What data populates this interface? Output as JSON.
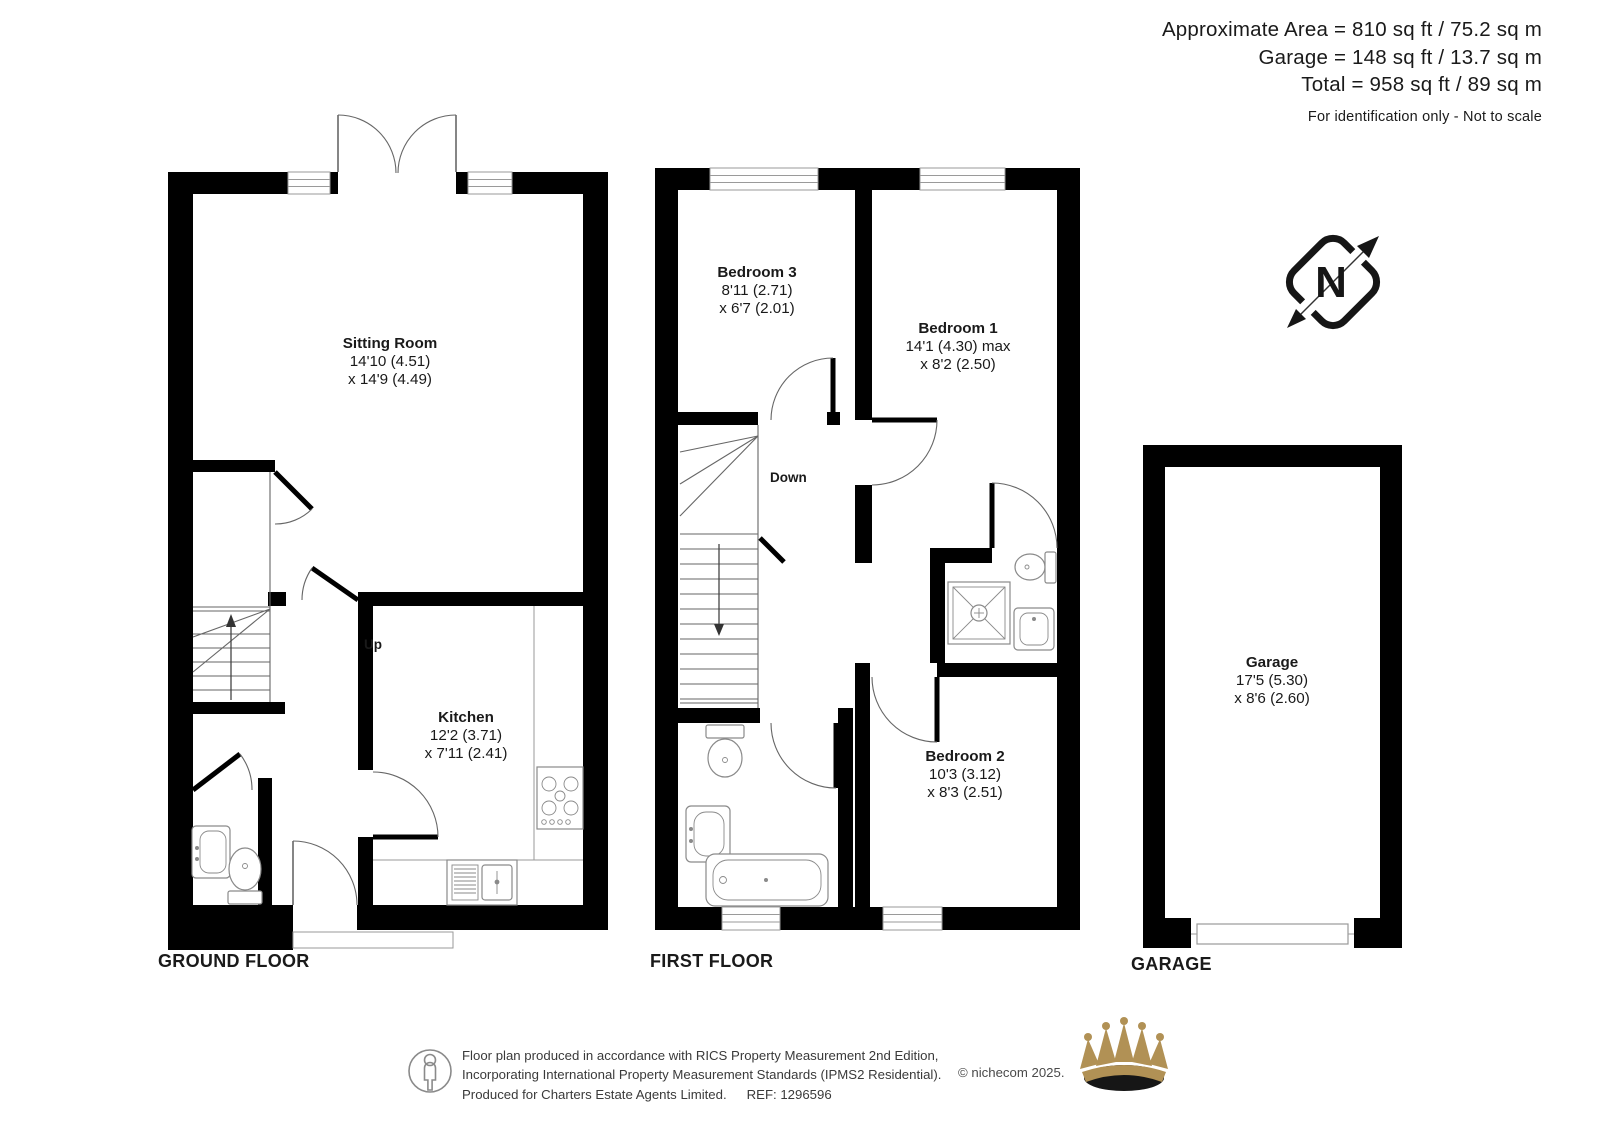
{
  "header": {
    "area_line": "Approximate Area = 810 sq ft / 75.2 sq m",
    "garage_line": "Garage = 148 sq ft / 13.7 sq m",
    "total_line": "Total = 958 sq ft / 89 sq m",
    "disclaimer": "For identification only - Not to scale"
  },
  "compass": {
    "north_label": "N"
  },
  "floors": {
    "ground": {
      "title": "GROUND FLOOR",
      "stairs_label": "Up",
      "rooms": {
        "sitting_room": {
          "name": "Sitting Room",
          "dim1": "14'10 (4.51)",
          "dim2": "x 14'9 (4.49)"
        },
        "kitchen": {
          "name": "Kitchen",
          "dim1": "12'2 (3.71)",
          "dim2": "x 7'11 (2.41)"
        }
      }
    },
    "first": {
      "title": "FIRST FLOOR",
      "stairs_label": "Down",
      "rooms": {
        "bedroom3": {
          "name": "Bedroom 3",
          "dim1": "8'11 (2.71)",
          "dim2": "x 6'7 (2.01)"
        },
        "bedroom1": {
          "name": "Bedroom 1",
          "dim1": "14'1 (4.30) max",
          "dim2": "x 8'2 (2.50)"
        },
        "bedroom2": {
          "name": "Bedroom 2",
          "dim1": "10'3 (3.12)",
          "dim2": "x 8'3 (2.51)"
        }
      }
    },
    "garage": {
      "title": "GARAGE",
      "rooms": {
        "garage": {
          "name": "Garage",
          "dim1": "17'5 (5.30)",
          "dim2": "x 8'6 (2.60)"
        }
      }
    }
  },
  "footer": {
    "line1": "Floor plan produced in accordance with RICS Property Measurement 2nd Edition,",
    "line2": "Incorporating International Property Measurement Standards (IPMS2 Residential).",
    "copyright": "© nichecom 2025.",
    "line3": "Produced for Charters Estate Agents Limited.",
    "ref": "REF: 1296596"
  },
  "icons": {
    "compass": "north-arrow-compass",
    "person": "person-accessibility-icon",
    "crown": "charters-crown-logo",
    "fixtures": [
      "toilet-icon",
      "basin-icon",
      "bath-icon",
      "shower-icon",
      "hob-icon",
      "kitchen-sink-icon"
    ]
  },
  "colors": {
    "wall": "#000000",
    "line": "#666666",
    "gold": "#b19155",
    "text": "#1a1a1a"
  }
}
